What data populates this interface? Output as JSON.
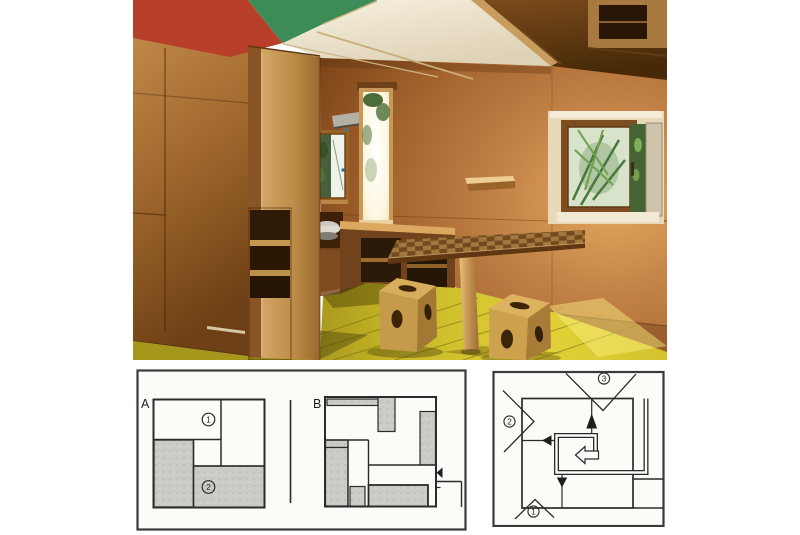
{
  "plans": {
    "plan_a": {
      "label": "A",
      "marker_1": "1",
      "marker_2": "2"
    },
    "plan_b": {
      "label": "B"
    }
  },
  "circulation": {
    "marker_1": "1",
    "marker_2": "2",
    "marker_3": "3"
  },
  "colors": {
    "ceiling_red": "#b8402a",
    "ceiling_green": "#3d8c58",
    "ceiling_cream": "#f2ecd9",
    "plywood_wall": "#b5793c",
    "floor_yellow": "#d9c52e",
    "diagram_line": "#2b2b2b",
    "diagram_shade": "#cccbc5",
    "panel_background": "#fcfbf8"
  }
}
